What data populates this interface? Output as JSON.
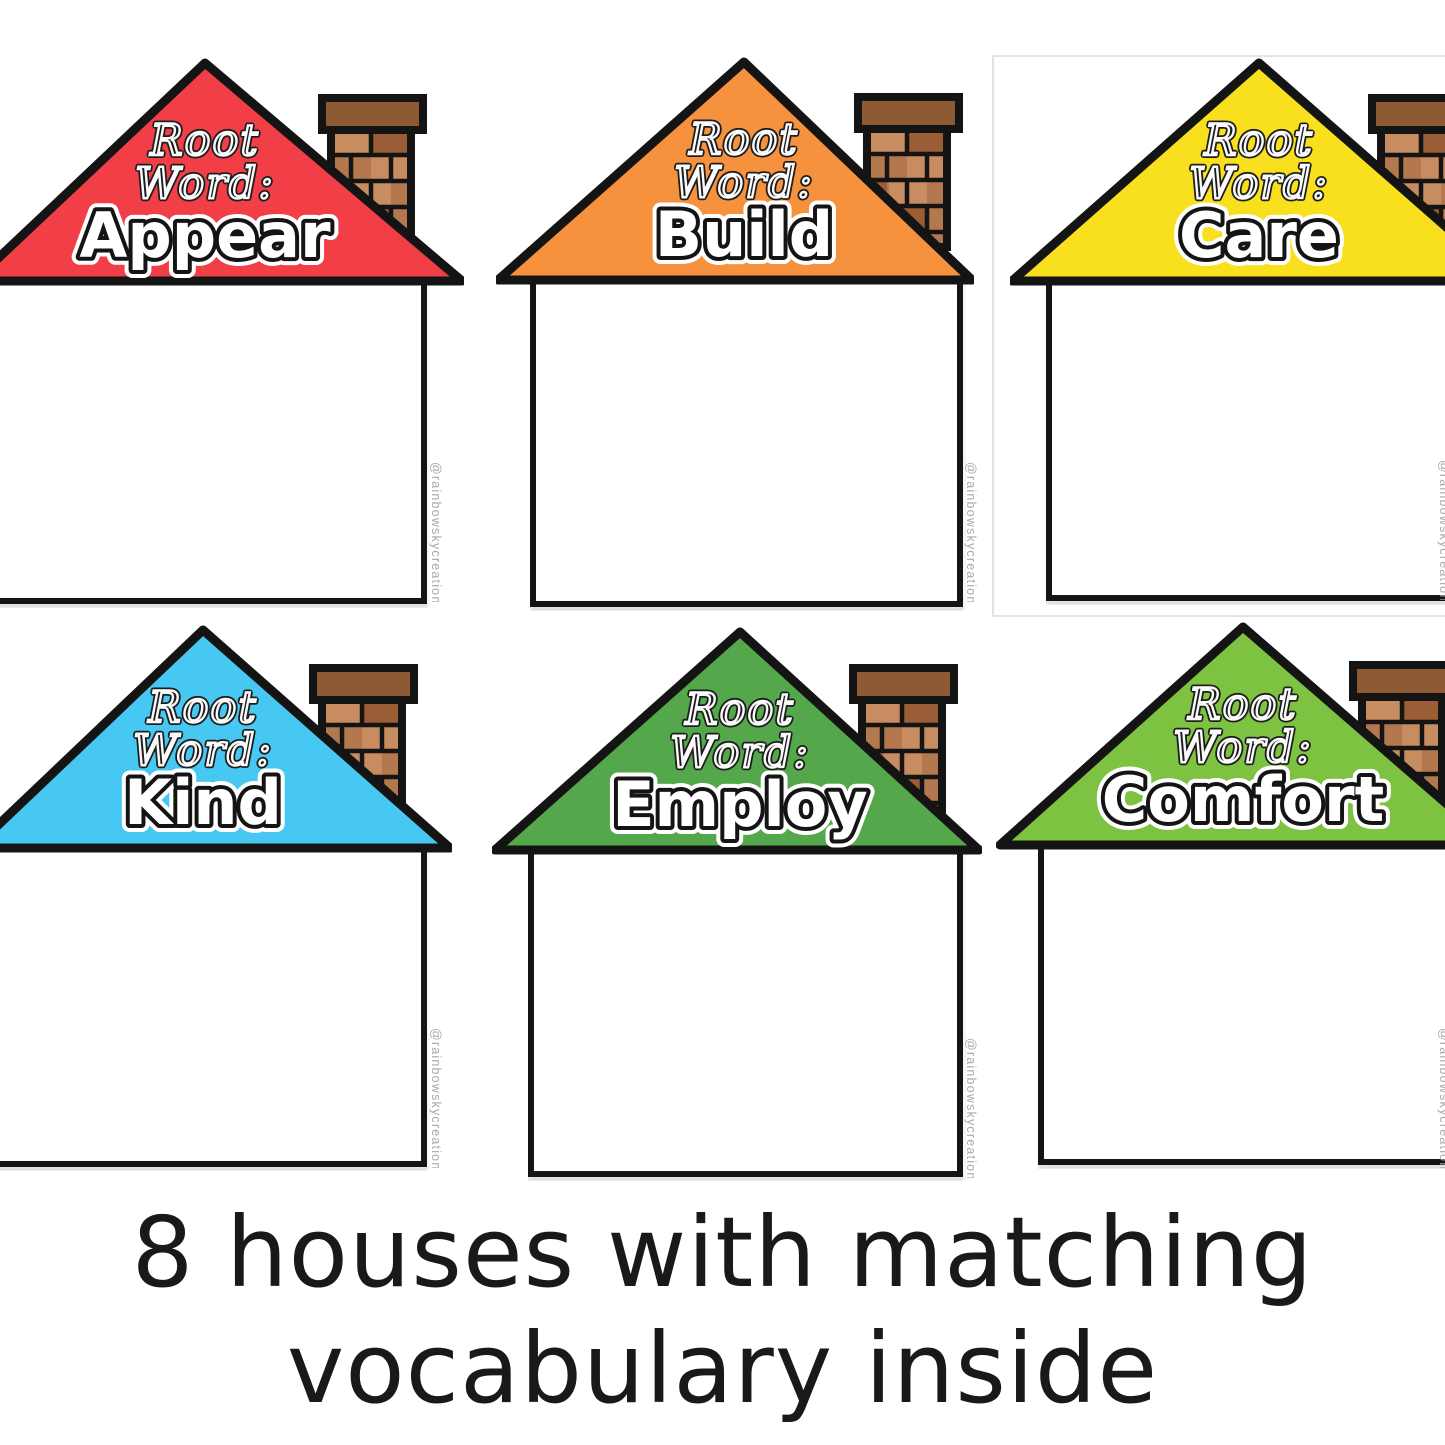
{
  "caption": {
    "line1": "8 houses with matching",
    "line2": "vocabulary inside"
  },
  "watermark_credit": "@rainbowskycreations",
  "roof_label": {
    "line1": "Root",
    "line2": "Word:"
  },
  "houses": [
    {
      "word": "Appear",
      "roof_color": "#F13E47"
    },
    {
      "word": "Build",
      "roof_color": "#F6913E"
    },
    {
      "word": "Care",
      "roof_color": "#F8E01E"
    },
    {
      "word": "Kind",
      "roof_color": "#47C8F2"
    },
    {
      "word": "Employ",
      "roof_color": "#54A84B"
    },
    {
      "word": "Comfort",
      "roof_color": "#7EC242"
    }
  ],
  "palette": {
    "outline": "#141414",
    "brick-mid": "#B4784E",
    "brick-light": "#C78C60",
    "brick-dark": "#9A5D35",
    "brick-cap": "#8D5A33",
    "watermark": "#a9a9a9",
    "card-border": "#e3e3e3"
  }
}
